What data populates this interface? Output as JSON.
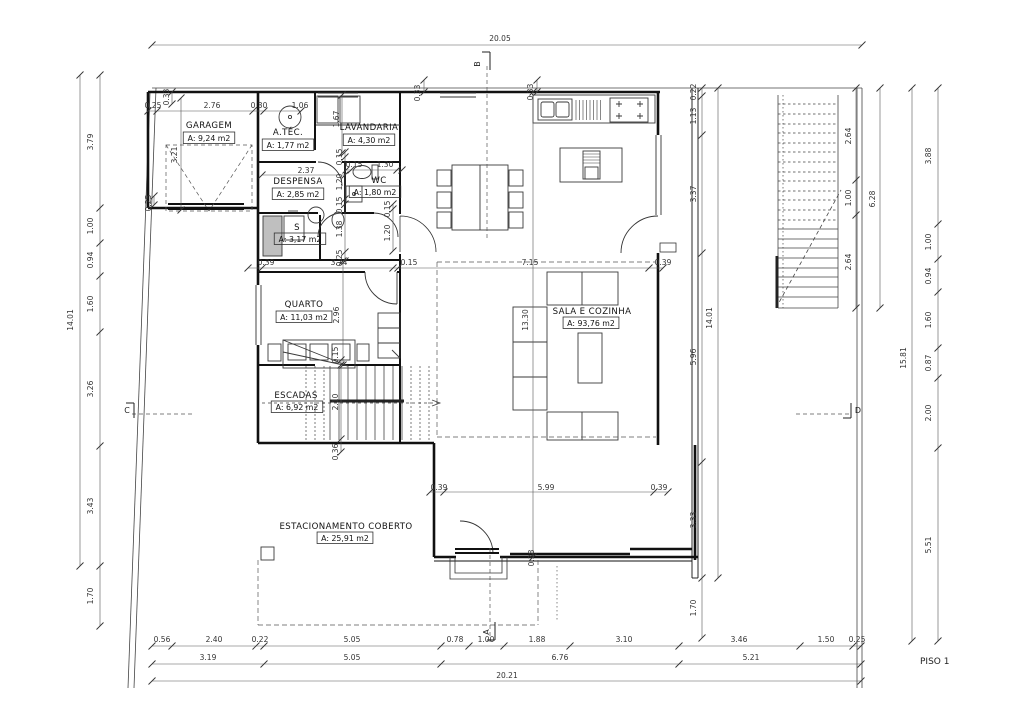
{
  "drawing": {
    "floor_label": "PISO 1",
    "colors": {
      "line": "#1a1a1a",
      "dim_text": "#333333",
      "background": "#ffffff"
    },
    "rooms": [
      {
        "name": "GARAGEM",
        "area": "A: 9,24 m2",
        "nx": 209,
        "ny": 128,
        "ax": 209,
        "ay": 141
      },
      {
        "name": "A.TÉC.",
        "area": "A: 1,77 m2",
        "nx": 288,
        "ny": 135,
        "ax": 288,
        "ay": 148
      },
      {
        "name": "LAVANDARIA",
        "area": "A: 4,30 m2",
        "nx": 369,
        "ny": 130,
        "ax": 369,
        "ay": 143
      },
      {
        "name": "DESPENSA",
        "area": "A: 2,85 m2",
        "nx": 298,
        "ny": 184,
        "ax": 298,
        "ay": 197
      },
      {
        "name": "WC",
        "area": "A: 1,80 m2",
        "nx": 379,
        "ny": 183,
        "ax": 375,
        "ay": 195
      },
      {
        "name": "S",
        "area": "A: 3,17 m2",
        "nx": 297,
        "ny": 230,
        "ax": 300,
        "ay": 242
      },
      {
        "name": "QUARTO",
        "area": "A: 11,03 m2",
        "nx": 304,
        "ny": 307,
        "ax": 304,
        "ay": 320
      },
      {
        "name": "ESCADAS",
        "area": "A: 6,92 m2",
        "nx": 296,
        "ny": 398,
        "ax": 297,
        "ay": 410
      },
      {
        "name": "SALA E COZINHA",
        "area": "A: 93,76 m2",
        "nx": 592,
        "ny": 314,
        "ax": 591,
        "ay": 326
      },
      {
        "name": "ESTACIONAMENTO COBERTO",
        "area": "A: 25,91 m2",
        "nx": 346,
        "ny": 529,
        "ax": 345,
        "ay": 541
      }
    ],
    "section_markers": [
      {
        "label": "B",
        "x": 480,
        "y": 64,
        "rot": -90
      },
      {
        "label": "A",
        "x": 489,
        "y": 632,
        "rot": -90
      },
      {
        "label": "C",
        "x": 127,
        "y": 413,
        "rot": 0
      },
      {
        "label": "D",
        "x": 858,
        "y": 413,
        "rot": 0
      }
    ],
    "dimensions": [
      {
        "t": "20.05",
        "x": 500,
        "y": 41
      },
      {
        "t": "0.56",
        "x": 162,
        "y": 642
      },
      {
        "t": "2.40",
        "x": 214,
        "y": 642
      },
      {
        "t": "0.22",
        "x": 260,
        "y": 642
      },
      {
        "t": "5.05",
        "x": 352,
        "y": 642
      },
      {
        "t": "0.78",
        "x": 455,
        "y": 642
      },
      {
        "t": "1.00",
        "x": 486,
        "y": 642
      },
      {
        "t": "1.88",
        "x": 537,
        "y": 642
      },
      {
        "t": "3.10",
        "x": 624,
        "y": 642
      },
      {
        "t": "3.46",
        "x": 739,
        "y": 642
      },
      {
        "t": "1.50",
        "x": 826,
        "y": 642
      },
      {
        "t": "0.25",
        "x": 857,
        "y": 642
      },
      {
        "t": "3.19",
        "x": 208,
        "y": 660
      },
      {
        "t": "5.05",
        "x": 352,
        "y": 660
      },
      {
        "t": "6.76",
        "x": 560,
        "y": 660
      },
      {
        "t": "5.21",
        "x": 751,
        "y": 660
      },
      {
        "t": "20.21",
        "x": 507,
        "y": 678
      },
      {
        "t": "14.01",
        "x": 73,
        "y": 320,
        "v": 1
      },
      {
        "t": "3.79",
        "x": 93,
        "y": 142,
        "v": 1
      },
      {
        "t": "1.00",
        "x": 93,
        "y": 226,
        "v": 1
      },
      {
        "t": "0.94",
        "x": 93,
        "y": 260,
        "v": 1
      },
      {
        "t": "1.60",
        "x": 93,
        "y": 304,
        "v": 1
      },
      {
        "t": "3.26",
        "x": 93,
        "y": 389,
        "v": 1
      },
      {
        "t": "3.43",
        "x": 93,
        "y": 506,
        "v": 1
      },
      {
        "t": "1.70",
        "x": 93,
        "y": 596,
        "v": 1
      },
      {
        "t": "15.81",
        "x": 906,
        "y": 358,
        "v": 1
      },
      {
        "t": "3.88",
        "x": 931,
        "y": 156,
        "v": 1
      },
      {
        "t": "1.00",
        "x": 931,
        "y": 242,
        "v": 1
      },
      {
        "t": "0.94",
        "x": 931,
        "y": 276,
        "v": 1
      },
      {
        "t": "1.60",
        "x": 931,
        "y": 320,
        "v": 1
      },
      {
        "t": "0.87",
        "x": 931,
        "y": 363,
        "v": 1
      },
      {
        "t": "2.00",
        "x": 931,
        "y": 413,
        "v": 1
      },
      {
        "t": "5.51",
        "x": 931,
        "y": 545,
        "v": 1
      },
      {
        "t": "2.64",
        "x": 851,
        "y": 136,
        "v": 1
      },
      {
        "t": "1.00",
        "x": 851,
        "y": 198,
        "v": 1
      },
      {
        "t": "2.64",
        "x": 851,
        "y": 262,
        "v": 1
      },
      {
        "t": "6.28",
        "x": 875,
        "y": 199,
        "v": 1
      },
      {
        "t": "0.22",
        "x": 696,
        "y": 92,
        "v": 1
      },
      {
        "t": "1.13",
        "x": 696,
        "y": 116,
        "v": 1
      },
      {
        "t": "3.37",
        "x": 696,
        "y": 194,
        "v": 1
      },
      {
        "t": "5.96",
        "x": 696,
        "y": 357,
        "v": 1
      },
      {
        "t": "3.33",
        "x": 696,
        "y": 520,
        "v": 1
      },
      {
        "t": "1.70",
        "x": 696,
        "y": 608,
        "v": 1
      },
      {
        "t": "14.01",
        "x": 712,
        "y": 318,
        "v": 1
      },
      {
        "t": "0.25",
        "x": 153,
        "y": 108
      },
      {
        "t": "2.76",
        "x": 212,
        "y": 108
      },
      {
        "t": "0.30",
        "x": 259,
        "y": 108
      },
      {
        "t": "1.06",
        "x": 300,
        "y": 108
      },
      {
        "t": "0.33",
        "x": 169,
        "y": 97,
        "v": 1
      },
      {
        "t": "3.21",
        "x": 177,
        "y": 155,
        "v": 1
      },
      {
        "t": "0.25",
        "x": 151,
        "y": 203,
        "v": 1
      },
      {
        "t": "0.33",
        "x": 420,
        "y": 93,
        "v": 1
      },
      {
        "t": "0.33",
        "x": 533,
        "y": 92,
        "v": 1
      },
      {
        "t": "1.67",
        "x": 339,
        "y": 119,
        "v": 1
      },
      {
        "t": "2.37",
        "x": 306,
        "y": 173
      },
      {
        "t": "0.15",
        "x": 354,
        "y": 167
      },
      {
        "t": "1.30",
        "x": 385,
        "y": 167
      },
      {
        "t": "0.15",
        "x": 342,
        "y": 157,
        "v": 1
      },
      {
        "t": "1.20",
        "x": 342,
        "y": 182,
        "v": 1
      },
      {
        "t": "0.15",
        "x": 342,
        "y": 205,
        "v": 1
      },
      {
        "t": "1.38",
        "x": 342,
        "y": 229,
        "v": 1
      },
      {
        "t": "0.25",
        "x": 342,
        "y": 258,
        "v": 1
      },
      {
        "t": "0.15",
        "x": 390,
        "y": 209,
        "v": 1
      },
      {
        "t": "1.20",
        "x": 390,
        "y": 233,
        "v": 1
      },
      {
        "t": "0.39",
        "x": 266,
        "y": 265
      },
      {
        "t": "3.74",
        "x": 339,
        "y": 265
      },
      {
        "t": "0.15",
        "x": 409,
        "y": 265
      },
      {
        "t": "7.15",
        "x": 530,
        "y": 265
      },
      {
        "t": "0.39",
        "x": 663,
        "y": 265
      },
      {
        "t": "2.96",
        "x": 339,
        "y": 315,
        "v": 1
      },
      {
        "t": "13.30",
        "x": 528,
        "y": 320,
        "v": 1
      },
      {
        "t": "0.15",
        "x": 338,
        "y": 355,
        "v": 1
      },
      {
        "t": "2.10",
        "x": 338,
        "y": 402,
        "v": 1
      },
      {
        "t": "0.36",
        "x": 338,
        "y": 452,
        "v": 1
      },
      {
        "t": "0.39",
        "x": 439,
        "y": 490
      },
      {
        "t": "5.99",
        "x": 546,
        "y": 490
      },
      {
        "t": "0.39",
        "x": 659,
        "y": 490
      },
      {
        "t": "0.38",
        "x": 534,
        "y": 558,
        "v": 1
      }
    ]
  }
}
